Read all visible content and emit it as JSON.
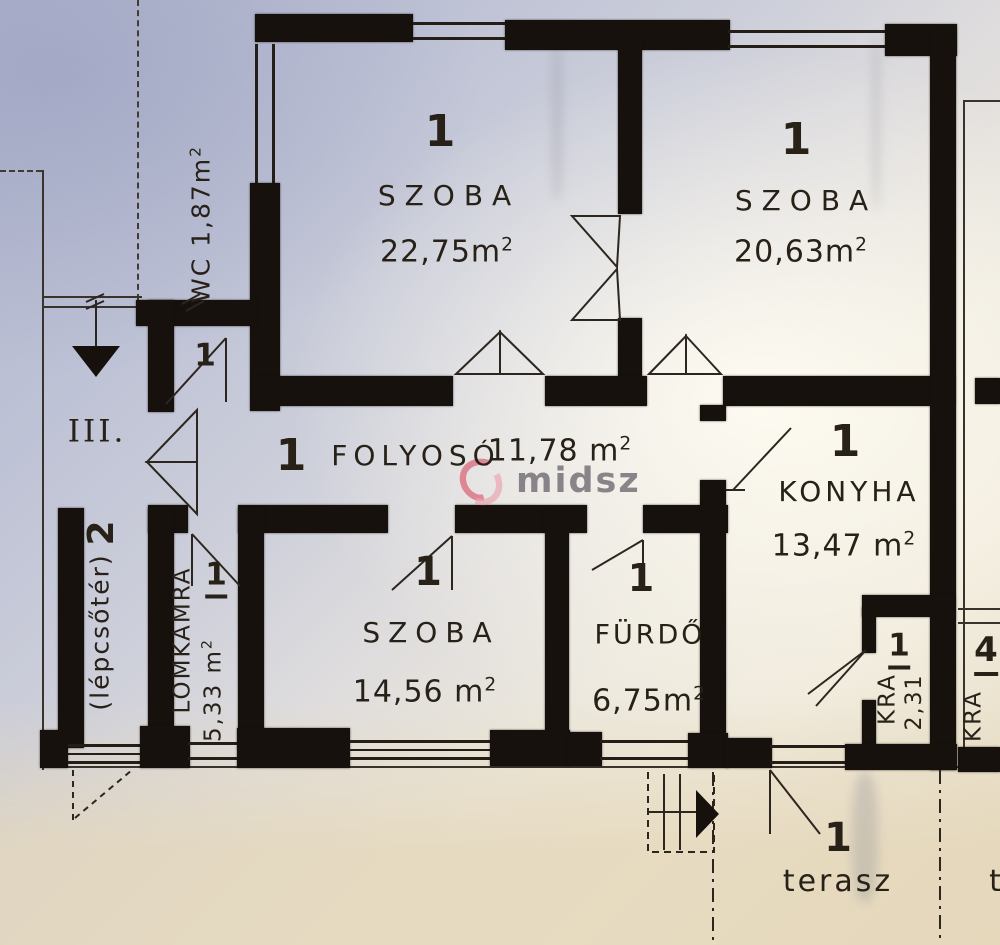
{
  "meta": {
    "floor_label": "III.",
    "watermark": "midsz",
    "sup": "2"
  },
  "colors": {
    "wall": "#16110c",
    "ink": "#272118",
    "paper_shadow": "#b2b6ce",
    "paper_light": "#f1ece0",
    "paper_bottom": "#e7dcc4",
    "watermark_red": "#d7495f",
    "watermark_pink": "#e895a5",
    "watermark_grey": "#6f6a72"
  },
  "rooms": {
    "szoba1": {
      "marker": "1",
      "name": "SZOBA",
      "area": "22,75m"
    },
    "szoba2": {
      "marker": "1",
      "name": "SZOBA",
      "area": "20,63m"
    },
    "wc": {
      "marker": "1",
      "label": "WC 1,87m"
    },
    "folyoso": {
      "marker": "1",
      "name": "FOLYOSÓ",
      "area": "11,78 m"
    },
    "konyha": {
      "marker": "1",
      "name": "KONYHA",
      "area": "13,47 m"
    },
    "lepcsoter": {
      "marker": "2",
      "name": "(lépcsőtér)"
    },
    "lomkamra": {
      "marker": "1",
      "name": "LOMKAMRA",
      "area": "5,33 m"
    },
    "szoba3": {
      "marker": "1",
      "name": "SZOBA",
      "area": "14,56 m"
    },
    "furdo": {
      "marker": "1",
      "name": "FÜRDŐ",
      "area": "6,75m"
    },
    "kra": {
      "marker": "1",
      "name": "KRA",
      "area": "2,31"
    },
    "terasz": {
      "marker": "1",
      "name": "terasz"
    },
    "neighbor": {
      "marker": "4",
      "name": "KRA",
      "terasz_partial": "t"
    }
  }
}
